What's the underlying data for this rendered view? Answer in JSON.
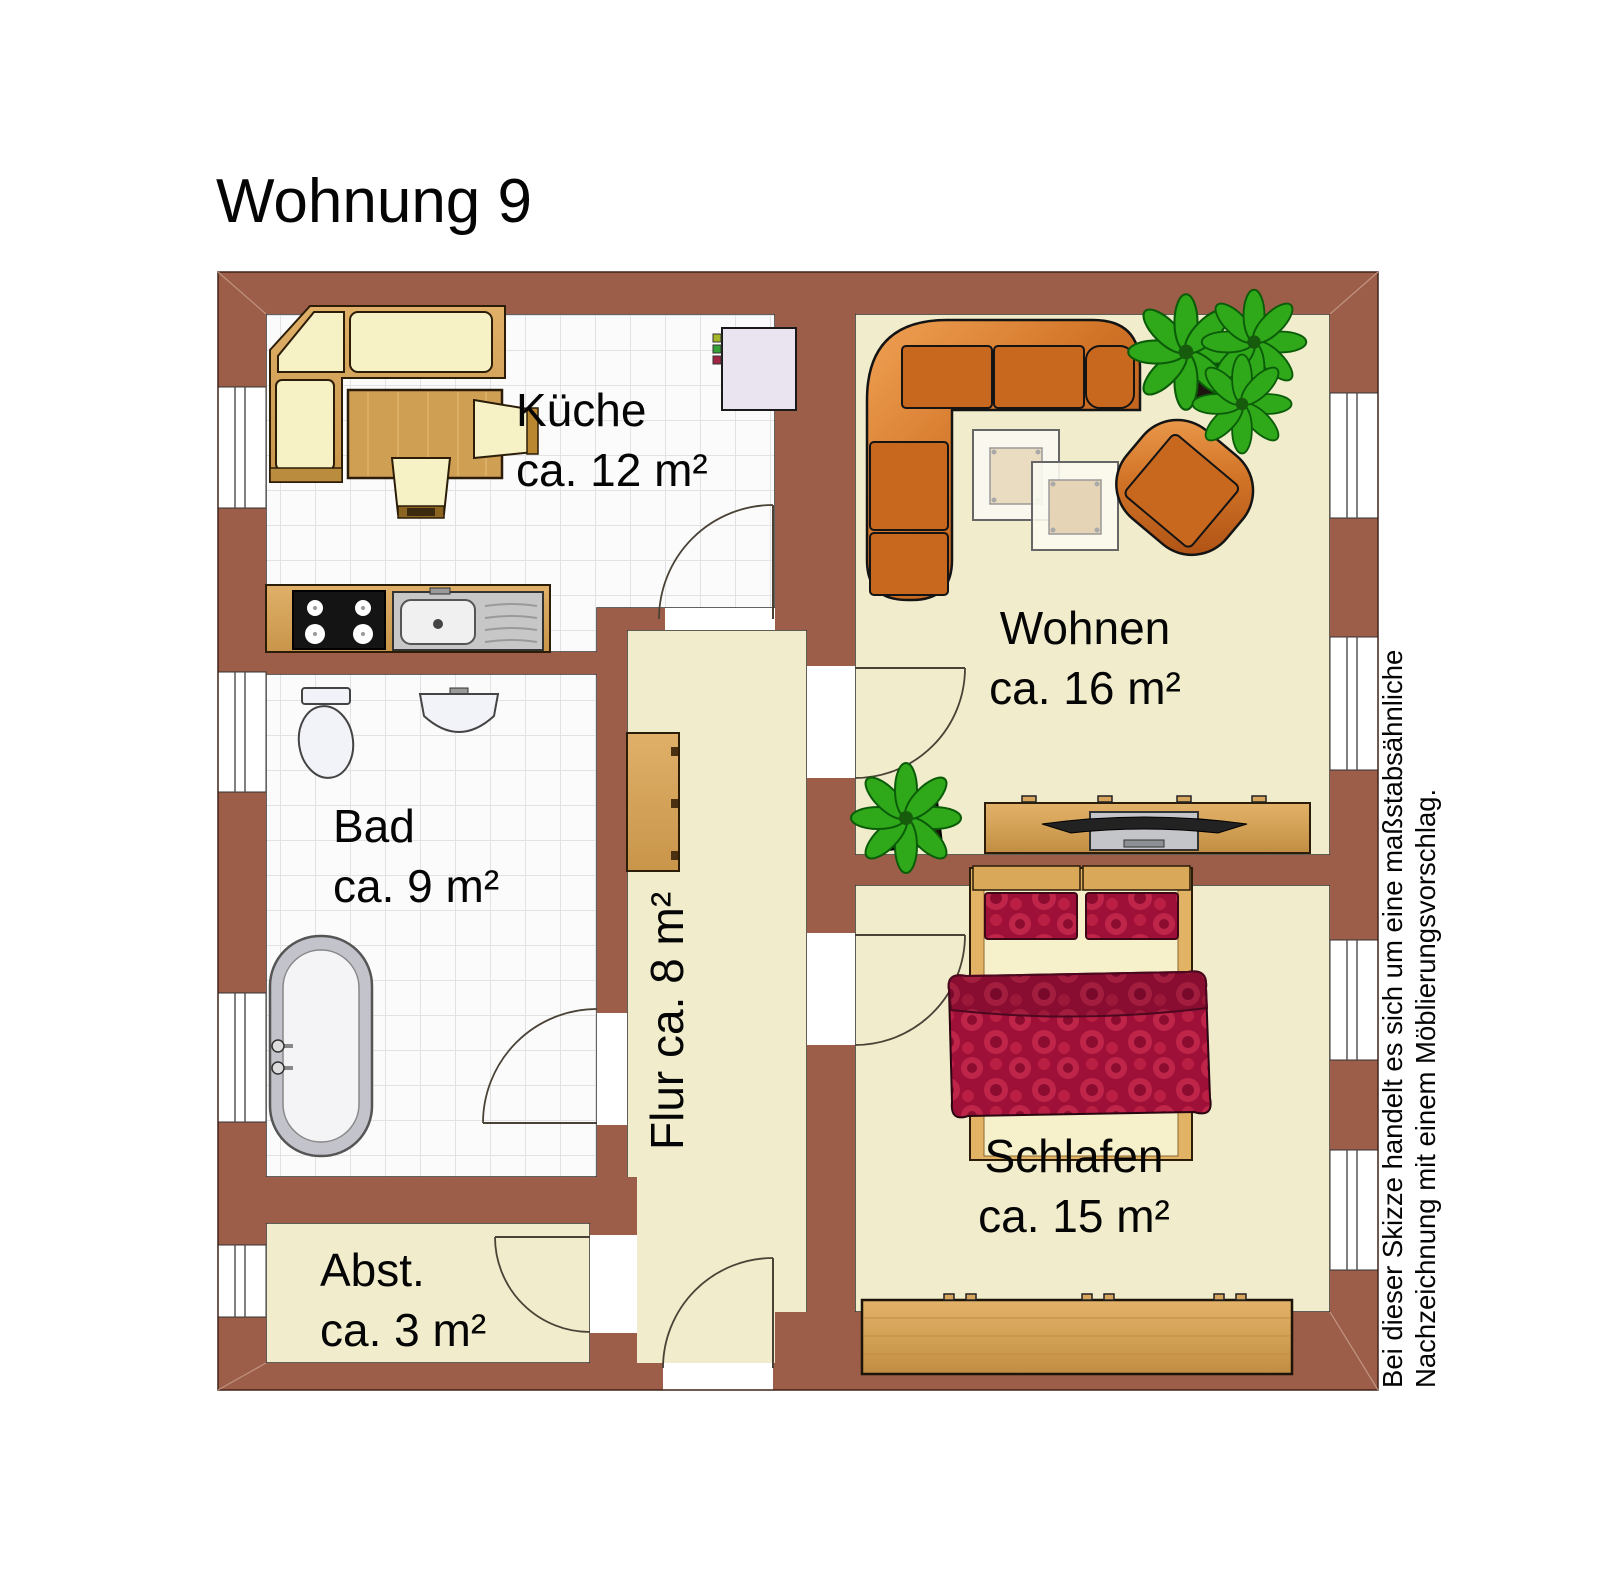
{
  "title": "Wohnung 9",
  "rooms": {
    "kueche": {
      "name": "Küche",
      "area": "ca. 12 m²"
    },
    "wohnen": {
      "name": "Wohnen",
      "area": "ca. 16 m²"
    },
    "bad": {
      "name": "Bad",
      "area": "ca. 9 m²"
    },
    "flur": {
      "name": "Flur",
      "area": "ca. 8 m²"
    },
    "schlafen": {
      "name": "Schlafen",
      "area": "ca. 15 m²"
    },
    "abstellraum": {
      "name": "Abst.",
      "area": "ca. 3 m²"
    }
  },
  "disclaimer": {
    "line1": "Bei dieser Skizze handelt es sich um eine maßstabsähnliche",
    "line2": "Nachzeichnung mit einem Möblierungsvorschlag."
  },
  "colors": {
    "wall": "#9c5d49",
    "floor_living": "#f1edcc",
    "floor_tile": "#fbfbfb",
    "tile_line": "#e2e2e2",
    "wood": "#d7a55b",
    "seat_cream": "#f7f1c6",
    "sofa_orange": "#c8681f",
    "bed_red": "#9e1038",
    "plant_green": "#2fa81a",
    "fridge_lavender": "#e9e4f0"
  }
}
